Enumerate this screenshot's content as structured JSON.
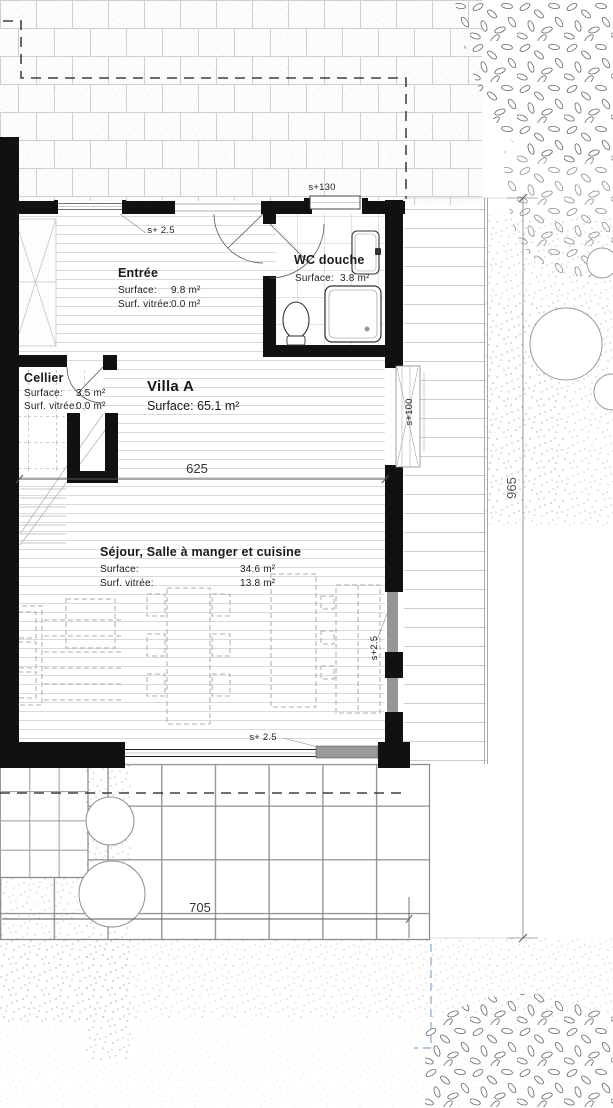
{
  "villa": {
    "name": "Villa A",
    "surface": "Surface: 65.1 m²"
  },
  "rooms": {
    "entree": {
      "name": "Entrée",
      "surface_label": "Surface:",
      "surface_value": "9.8 m²",
      "glazed_label": "Surf. vitrée:",
      "glazed_value": "0.0 m²"
    },
    "wc": {
      "name": "WC douche",
      "surface_label": "Surface:",
      "surface_value": "3.8 m²"
    },
    "cellier": {
      "name": "Cellier",
      "surface_label": "Surface:",
      "surface_value": "3.5 m²",
      "glazed_label": "Surf. vitrée:",
      "glazed_value": "0.0 m²"
    },
    "sejour": {
      "name": "Séjour, Salle à manger et cuisine",
      "surface_label": "Surface:",
      "surface_value": "34.6 m²",
      "glazed_label": "Surf. vitrée:",
      "glazed_value": "13.8 m²"
    }
  },
  "dimensions": {
    "living_width": "625",
    "terrace_width": "705",
    "garden_depth": "965"
  },
  "levels": {
    "entry_window": "s+ 2.5",
    "wc_window": "s+130",
    "side_window": "s+100",
    "living_window": "s+2.5",
    "terrace_door": "s+ 2.5"
  },
  "colors": {
    "wall": "#111111",
    "glazing": "#9a9a9a",
    "boundary_blue": "#8aa8c8"
  }
}
